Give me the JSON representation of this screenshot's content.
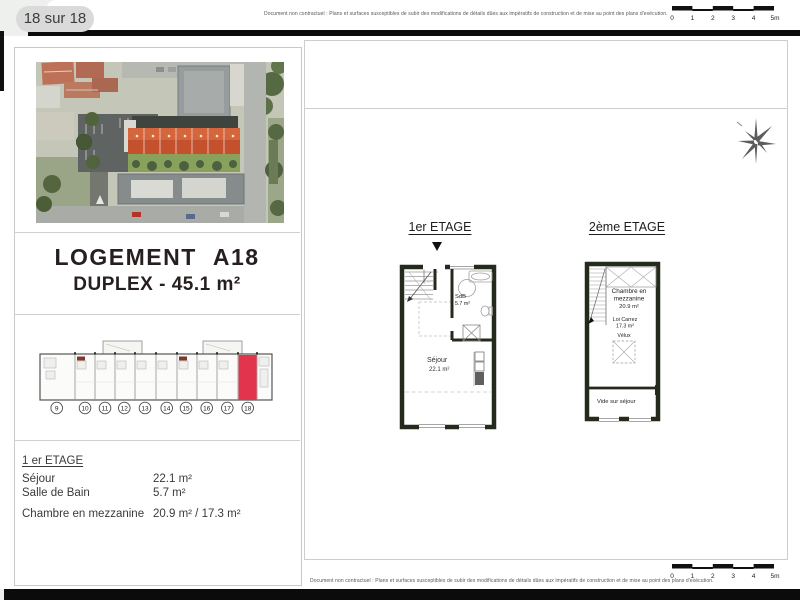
{
  "page": {
    "indicator": "18 sur 18"
  },
  "disclaimer": "Document non contractuel : Plans et surfaces susceptibles de subir des modifications de détails dûes aux impératifs de construction et de mise au point des plans d'exécution.",
  "scalebar": {
    "labels": [
      "0",
      "1",
      "2",
      "3",
      "4",
      "5m"
    ]
  },
  "title": {
    "line1": "LOGEMENT A18",
    "line2": "DUPLEX - 45.1 m²"
  },
  "key_plan": {
    "units": [
      "9",
      "10",
      "11",
      "12",
      "13",
      "14",
      "15",
      "16",
      "17",
      "18"
    ],
    "highlighted_unit": "18"
  },
  "areas": {
    "heading": "1 er ETAGE",
    "rows": [
      {
        "label": "Séjour",
        "value": "22.1 m²"
      },
      {
        "label": "Salle de Bain",
        "value": "5.7 m²"
      },
      {
        "label": "Chambre en mezzanine",
        "value": "20.9 m² / 17.3 m²"
      }
    ]
  },
  "plans": {
    "p1": {
      "heading": "1er ETAGE",
      "sdb": "SdB",
      "sdb_area": "5.7 m²",
      "sejour": "Séjour",
      "sejour_area": "22.1 m²"
    },
    "p2": {
      "heading": "2ème ETAGE",
      "chambre1": "Chambre en",
      "chambre2": "mezzanine",
      "chambre_area": "20.9 m²",
      "loi": "Loi Carrez",
      "loi_area": "17.3 m²",
      "velux": "Vélux",
      "vide": "Vide sur séjour"
    }
  },
  "colors": {
    "highlight_red": "#e3344e",
    "roof_orange": "#c4512d",
    "plan_wall": "#242a1c",
    "page_gap_black": "#0b0b0b",
    "pill_gray": "#dadada"
  }
}
